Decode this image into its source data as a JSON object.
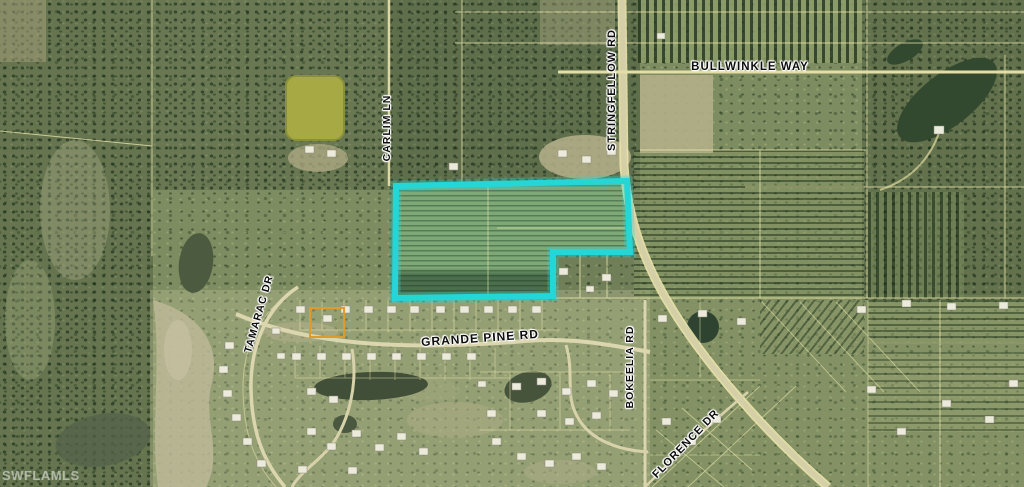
{
  "map": {
    "watermark": "SWFLAMLS",
    "roads": {
      "bullwinkle_way": "BULLWINKLE WAY",
      "stringfellow_rd": "STRINGFELLOW RD",
      "carlim_ln": "CARLIM LN",
      "tamarac_dr": "TAMARAC DR",
      "grande_pine_rd": "GRANDE PINE RD",
      "bokeelia_rd": "BOKEELIA RD",
      "florence_dr": "FLORENCE DR"
    }
  },
  "colors": {
    "highlight_parcel": "#25d6d6",
    "secondary_lot": "#e09b2d",
    "parcel_lines": "#f2edb0"
  }
}
